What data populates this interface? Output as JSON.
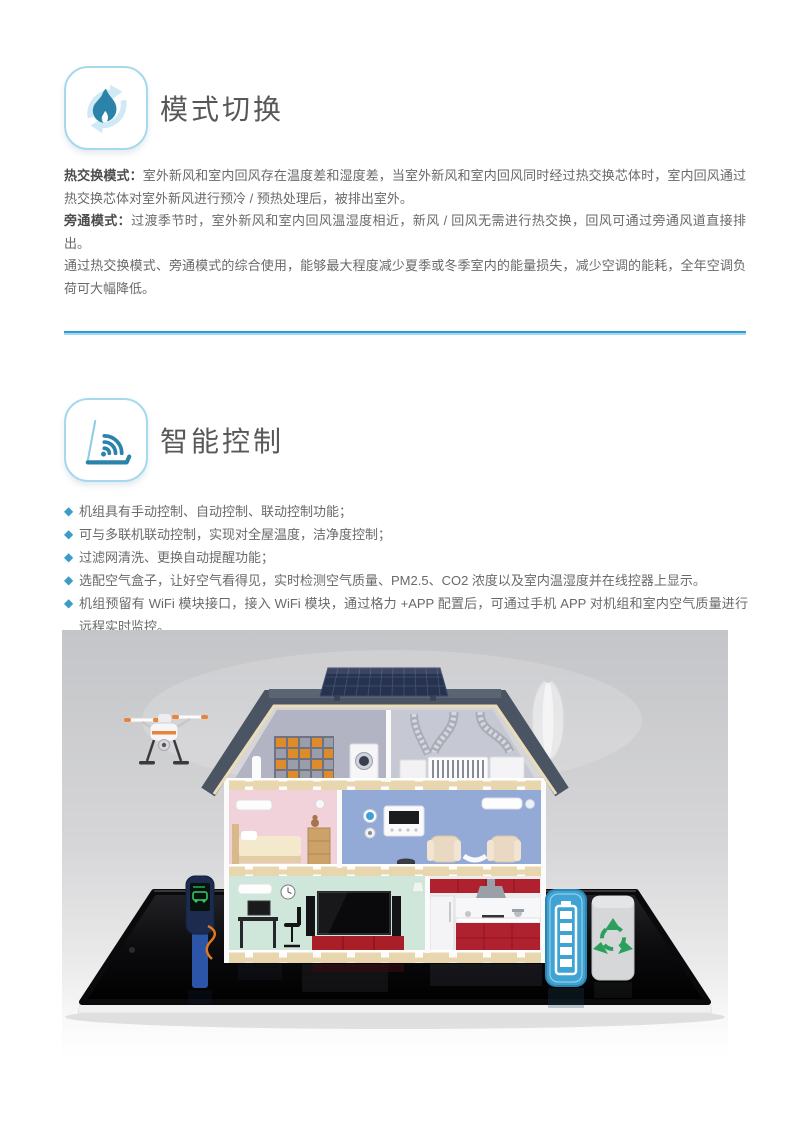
{
  "accent": {
    "divider_dark": "#2f9cd3",
    "divider_light": "#a6d8ec",
    "bullet": "#3a9cc8",
    "icon_border": "#a6d9ee",
    "icon_glyph": "#2b83aa"
  },
  "section1": {
    "title": "模式切换",
    "paragraphs": [
      {
        "label": "热交换模式：",
        "text": "室外新风和室内回风存在温度差和湿度差，当室外新风和室内回风同时经过热交换芯体时，室内回风通过热交换芯体对室外新风进行预冷 / 预热处理后，被排出室外。"
      },
      {
        "label": "旁通模式：",
        "text": "过渡季节时，室外新风和室内回风温湿度相近，新风 / 回风无需进行热交换，回风可通过旁通风道直接排出。"
      },
      {
        "label": "",
        "text": "通过热交换模式、旁通模式的综合使用，能够最大程度减少夏季或冬季室内的能量损失，减少空调的能耗，全年空调负荷可大幅降低。"
      }
    ]
  },
  "section2": {
    "title": "智能控制",
    "bullet_marker": "◆",
    "bullets": [
      "机组具有手动控制、自动控制、联动控制功能；",
      "可与多联机联动控制，实现对全屋温度，洁净度控制；",
      "过滤网清洗、更换自动提醒功能；",
      "选配空气盒子，让好空气看得见，实时检测空气质量、PM2.5、CO2 浓度以及室内温湿度并在线控器上显示。",
      "机组预留有 WiFi 模块接口，接入 WiFi 模块，通过格力 +APP 配置后，可通过手机 APP 对机组和室内空气质量进行远程实时监控。"
    ]
  },
  "illustration": {
    "subject": "smart-home-cutaway-on-tablet",
    "elements": [
      "drone",
      "solar-panel",
      "wind-turbine",
      "attic-hrv-ducts",
      "bedroom",
      "smart-thermostat-room",
      "living-room",
      "kitchen",
      "ev-charger",
      "home-battery",
      "recycle-bin",
      "tablet"
    ],
    "palette": {
      "backdrop_top": "#c4c5c8",
      "backdrop_bottom": "#ffffff",
      "roof": "#4a5462",
      "solar_panel": "#27324f",
      "bedroom_wall": "#f2d2da",
      "smart_room_wall": "#93a9d6",
      "living_wall": "#cfe7db",
      "kitchen_red": "#b02130",
      "floor_band": "#e8d6ae",
      "tablet_black": "#0c0c0f",
      "battery_blue": "#3fa3d4",
      "recycle_green": "#2ba05c",
      "drone_accent": "#e8833a"
    }
  }
}
